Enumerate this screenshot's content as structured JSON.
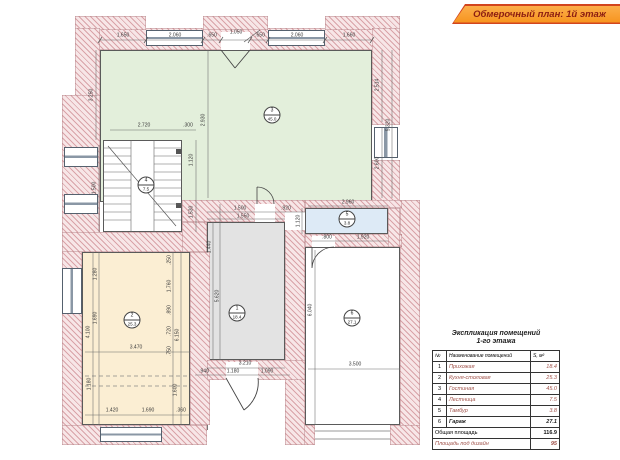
{
  "banner": {
    "title": "Обмерочный план: 1й этаж"
  },
  "explication": {
    "title_line1": "Экспликация помещений",
    "title_line2": "1-го этажа",
    "col_num": "№",
    "col_name": "Наименование помещений",
    "col_area": "S, м²",
    "rows": [
      {
        "num": "1",
        "name": "Прихожая",
        "area": "18.4"
      },
      {
        "num": "2",
        "name": "Кухня-столовая",
        "area": "25.3"
      },
      {
        "num": "3",
        "name": "Гостиная",
        "area": "45.0"
      },
      {
        "num": "4",
        "name": "Лестница",
        "area": "7.5"
      },
      {
        "num": "5",
        "name": "Тамбур",
        "area": "3.8"
      },
      {
        "num": "6",
        "name": "Гараж",
        "area": "27.1"
      }
    ],
    "total_label": "Общая площадь",
    "total_value": "116.9",
    "design_label": "Площадь под дизайн",
    "design_value": "95"
  },
  "colors": {
    "banner_orange": "#f7941e",
    "banner_border": "#d2451e",
    "banner_text": "#8c1d12",
    "wall_hatch_line": "#d9a3a8",
    "wall_fill": "#f7e6e7",
    "room_living": "#e3efdb",
    "room_kitchen": "#fbeed3",
    "room_hall": "#e3e3e3",
    "room_tambour": "#ddeaf6",
    "room_garage": "#ffffff",
    "dim_text": "#3a3a3a",
    "table_name_text": "#a0524a"
  },
  "plan": {
    "markers": [
      {
        "num": "3",
        "area": "45.0",
        "x": 272,
        "y": 115
      },
      {
        "num": "4",
        "area": "7.5",
        "x": 146,
        "y": 185
      },
      {
        "num": "2",
        "area": "25.3",
        "x": 132,
        "y": 320
      },
      {
        "num": "1",
        "area": "18.4",
        "x": 237,
        "y": 313
      },
      {
        "num": "5",
        "area": "3.8",
        "x": 347,
        "y": 219
      },
      {
        "num": "6",
        "area": "27.1",
        "x": 352,
        "y": 318
      }
    ],
    "dim_labels": [
      {
        "t": "1.650",
        "x": 123,
        "y": 36,
        "r": 0
      },
      {
        "t": "2.060",
        "x": 175,
        "y": 36,
        "r": 0
      },
      {
        "t": ".650",
        "x": 212,
        "y": 36,
        "r": 0
      },
      {
        "t": "1.050",
        "x": 236,
        "y": 33,
        "r": 0
      },
      {
        "t": ".650",
        "x": 260,
        "y": 36,
        "r": 0
      },
      {
        "t": "2.060",
        "x": 297,
        "y": 36,
        "r": 0
      },
      {
        "t": "1.660",
        "x": 349,
        "y": 36,
        "r": 0
      },
      {
        "t": "3.250",
        "x": 92,
        "y": 95,
        "r": 90
      },
      {
        "t": "1.500",
        "x": 95,
        "y": 188,
        "r": 90
      },
      {
        "t": "2.930",
        "x": 204,
        "y": 120,
        "r": 90
      },
      {
        "t": "2.720",
        "x": 144,
        "y": 126,
        "r": 0
      },
      {
        "t": ".300",
        "x": 188,
        "y": 126,
        "r": 0
      },
      {
        "t": "2.514",
        "x": 378,
        "y": 85,
        "r": 90
      },
      {
        "t": "5.320",
        "x": 389,
        "y": 125,
        "r": 90
      },
      {
        "t": "2.600",
        "x": 378,
        "y": 163,
        "r": 90
      },
      {
        "t": "1.120",
        "x": 192,
        "y": 160,
        "r": 90
      },
      {
        "t": "1.530",
        "x": 192,
        "y": 212,
        "r": 90
      },
      {
        "t": "1.500",
        "x": 240,
        "y": 209,
        "r": 0
      },
      {
        "t": ".920",
        "x": 286,
        "y": 209,
        "r": 0
      },
      {
        "t": "1.550",
        "x": 243,
        "y": 217,
        "r": 0
      },
      {
        "t": "1.440",
        "x": 210,
        "y": 247,
        "r": 90
      },
      {
        "t": "5.620",
        "x": 218,
        "y": 296,
        "r": 90
      },
      {
        "t": "3.210",
        "x": 245,
        "y": 364,
        "r": 0
      },
      {
        "t": ".940",
        "x": 204,
        "y": 372,
        "r": 0
      },
      {
        "t": "1.180",
        "x": 233,
        "y": 372,
        "r": 0
      },
      {
        "t": "1.090",
        "x": 267,
        "y": 372,
        "r": 0
      },
      {
        "t": "2.960",
        "x": 348,
        "y": 203,
        "r": 0
      },
      {
        "t": "1.120",
        "x": 299,
        "y": 221,
        "r": 90
      },
      {
        "t": ".800",
        "x": 327,
        "y": 238,
        "r": 0
      },
      {
        "t": "1.920",
        "x": 363,
        "y": 238,
        "r": 0
      },
      {
        "t": "1.280",
        "x": 96,
        "y": 274,
        "r": 90
      },
      {
        "t": "1.690",
        "x": 96,
        "y": 318,
        "r": 90
      },
      {
        "t": "4.100",
        "x": 89,
        "y": 332,
        "r": 90
      },
      {
        "t": ".250",
        "x": 170,
        "y": 260,
        "r": 90
      },
      {
        "t": "1.760",
        "x": 170,
        "y": 286,
        "r": 90
      },
      {
        "t": ".890",
        "x": 170,
        "y": 310,
        "r": 90
      },
      {
        "t": ".720",
        "x": 170,
        "y": 331,
        "r": 90
      },
      {
        "t": ".750",
        "x": 170,
        "y": 351,
        "r": 90
      },
      {
        "t": "6.150",
        "x": 178,
        "y": 335,
        "r": 90
      },
      {
        "t": "1.420",
        "x": 112,
        "y": 411,
        "r": 0
      },
      {
        "t": "1.690",
        "x": 148,
        "y": 411,
        "r": 0
      },
      {
        "t": ".360",
        "x": 181,
        "y": 411,
        "r": 0
      },
      {
        "t": "3.470",
        "x": 136,
        "y": 348,
        "r": 0
      },
      {
        "t": "1.180",
        "x": 90,
        "y": 384,
        "r": 90
      },
      {
        "t": "1.600",
        "x": 176,
        "y": 390,
        "r": 90
      },
      {
        "t": "6.040",
        "x": 311,
        "y": 310,
        "r": 90
      },
      {
        "t": "3.500",
        "x": 355,
        "y": 365,
        "r": 0
      }
    ]
  }
}
